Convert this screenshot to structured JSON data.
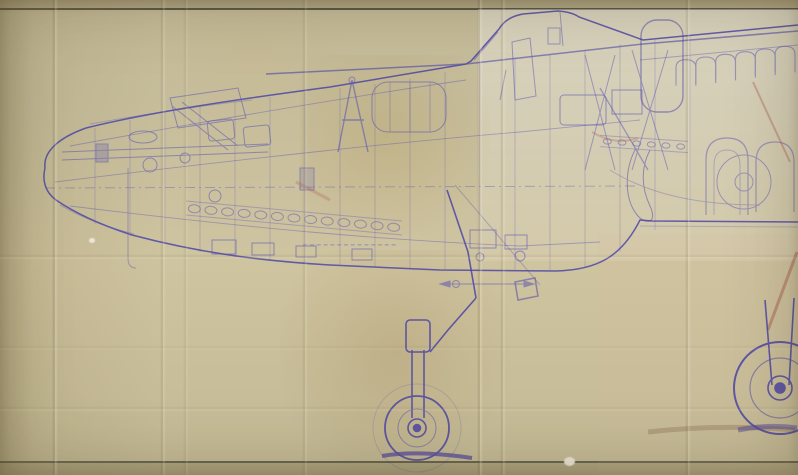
{
  "figure": {
    "description": "Photograph of an aged, fold-creased blueprint: side cutaway engineering drawing of an aircraft fuselage with internal frames, equipment, a lowered landing-gear leg with small wheel at bottom centre and a larger main wheel at bottom right; faint illegible stamp text near the centre; ruled border lines at top and bottom of the sheet",
    "stamp": {
      "legible": false,
      "dash_count": 14
    },
    "border_top_y": 9,
    "border_bottom_y": 462,
    "creases": {
      "vertical": [
        {
          "x": 55,
          "s": 0.9
        },
        {
          "x": 163,
          "s": 0.7
        },
        {
          "x": 186,
          "s": 0.45
        },
        {
          "x": 305,
          "s": 0.6
        },
        {
          "x": 480,
          "s": 1.0
        },
        {
          "x": 503,
          "s": 0.75
        },
        {
          "x": 688,
          "s": 0.8
        }
      ],
      "horizontal": [
        {
          "y": 257,
          "s": 0.45
        },
        {
          "y": 348,
          "s": 0.25
        },
        {
          "y": 409,
          "s": 0.35
        }
      ]
    },
    "frames": [
      [
        95,
        128,
        224
      ],
      [
        130,
        120,
        236
      ],
      [
        165,
        112,
        244
      ],
      [
        200,
        106,
        252
      ],
      [
        235,
        101,
        257
      ],
      [
        270,
        97,
        261
      ],
      [
        305,
        92,
        263
      ],
      [
        340,
        88,
        265
      ],
      [
        375,
        84,
        267
      ],
      [
        410,
        78,
        268
      ],
      [
        445,
        72,
        269
      ],
      [
        480,
        62,
        270
      ],
      [
        515,
        58,
        270
      ],
      [
        550,
        55,
        270
      ],
      [
        585,
        50,
        268
      ],
      [
        620,
        44,
        252
      ],
      [
        655,
        40,
        230
      ],
      [
        690,
        36,
        222
      ]
    ],
    "rivet_rows": [
      {
        "x1": 186,
        "y1": 208,
        "x2": 402,
        "y2": 228,
        "count": 13,
        "rx": 6,
        "ry": 4
      },
      {
        "x1": 600,
        "y1": 141,
        "x2": 688,
        "y2": 147,
        "count": 6,
        "rx": 4,
        "ry": 2.6
      }
    ],
    "scallops": {
      "x1": 676,
      "y1": 87,
      "x2": 795,
      "y2": 71,
      "count": 6,
      "height": 26
    },
    "stamp_dashes": {
      "x": 303,
      "y": 244,
      "step": 6.8,
      "w": 4.4,
      "h": 1.6
    },
    "nose_wheel": {
      "cx": 417,
      "cy": 428,
      "r_tire": 32,
      "r_ghost": 44,
      "r_rim": 19,
      "r_hub": 9,
      "r_axle": 3.5
    },
    "main_wheel": {
      "cx": 780,
      "cy": 388,
      "r_tire": 46,
      "r_rim": 30,
      "r_hub": 12,
      "r_axle": 5
    }
  },
  "palette": {
    "paper_base": "#c6bd9c",
    "paper_center": "#cfc4a0",
    "border_line": "#3a372c",
    "ink": "#5b55b2",
    "ink_strong": "#453ea6",
    "ink_faint": "#8781c6",
    "smudge": "#4338a0",
    "accent_red": "#a85f50",
    "accent_brown": "#8a6a4f",
    "crease_shadow": "rgba(92,80,48,0.22)",
    "crease_light": "rgba(255,250,228,0.30)"
  }
}
